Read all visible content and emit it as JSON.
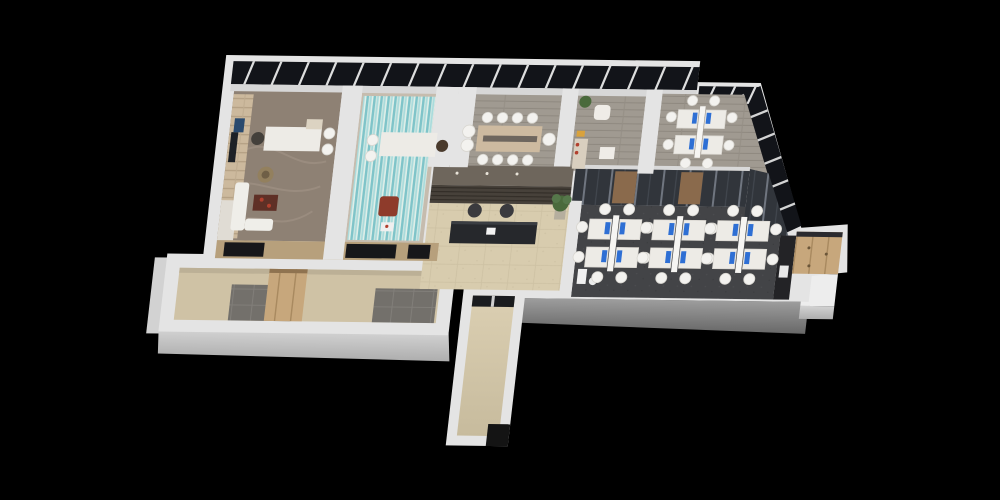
{
  "scene": {
    "type": "3d-isometric-office-floorplan-render",
    "rooms": [
      {
        "id": "executive-office",
        "floor": "wood-swirl-brown"
      },
      {
        "id": "meeting-room",
        "floor": "teal-striped-carpet"
      },
      {
        "id": "conference-room",
        "floor": "gray-wood-plank"
      },
      {
        "id": "lounge-pantry",
        "floor": "gray-wood-plank"
      },
      {
        "id": "private-office",
        "floor": "gray-wood-plank",
        "workstations": 4
      },
      {
        "id": "open-office",
        "floor": "dark-gray-carpet",
        "workstations": 12
      },
      {
        "id": "reception",
        "floor": "beige-marble"
      },
      {
        "id": "storage-locker-room",
        "floor": "light-wood-lockers"
      },
      {
        "id": "annex-utility-room",
        "floor": "gray-tile-and-wood"
      },
      {
        "id": "elevator-corridor",
        "floor": "beige-marble"
      }
    ],
    "facade": {
      "top_band": {
        "x": 234,
        "y": 61,
        "w": 466,
        "h": 23,
        "mullions": 17,
        "lean": 7
      },
      "right_band": {
        "x": 702,
        "y": 80,
        "w": 61,
        "h": 17,
        "mullions": 3,
        "lean": 6
      },
      "diagonal_band": {
        "x1": 763,
        "y1": 79,
        "x2": 820,
        "y2": 218,
        "dx": -16,
        "dy": 7,
        "mullions": 5
      }
    },
    "workstation_pods": {
      "pod": {
        "w": 52,
        "h": 56
      },
      "open_office": [
        [
          608,
          210
        ],
        [
          672,
          210
        ],
        [
          736,
          210
        ]
      ],
      "private_office": [
        [
          684,
          100
        ]
      ]
    },
    "furniture": {
      "executive_office": {
        "desk": {
          "x": 274,
          "y": 126,
          "w": 56,
          "h": 24
        },
        "exec_chair": [
          267,
          138
        ],
        "guest_chairs": [
          [
            338,
            132
          ],
          [
            338,
            148
          ]
        ],
        "sofa_a": {
          "x": 250,
          "y": 182,
          "w": 14,
          "h": 48
        },
        "sofa_b": {
          "x": 264,
          "y": 218,
          "w": 28,
          "h": 12
        },
        "coffee_table": {
          "x": 270,
          "y": 194,
          "w": 24,
          "h": 16
        },
        "rattan_chair": [
          279,
          174
        ],
        "tv": {
          "x": 240,
          "y": 132,
          "w": 7,
          "h": 30
        }
      },
      "meeting_room": {
        "desk": {
          "x": 390,
          "y": 130,
          "w": 56,
          "h": 24
        },
        "host_chair": [
          452,
          143
        ],
        "guest_chairs": [
          [
            382,
            138
          ],
          [
            382,
            154
          ]
        ],
        "armchair": {
          "x": 396,
          "y": 194,
          "w": 19,
          "h": 20
        },
        "magazine": {
          "x": 400,
          "y": 220,
          "w": 13,
          "h": 9
        }
      },
      "conference_room": {
        "table": {
          "x": 486,
          "y": 122,
          "w": 64,
          "h": 26
        },
        "chairs": [
          [
            494,
            114
          ],
          [
            509,
            114
          ],
          [
            524,
            114
          ],
          [
            539,
            114
          ],
          [
            494,
            156
          ],
          [
            509,
            156
          ],
          [
            524,
            156
          ],
          [
            539,
            156
          ],
          [
            477,
            128
          ],
          [
            477,
            142
          ],
          [
            558,
            135
          ]
        ]
      },
      "lounge": {
        "plant": [
          590,
          97
        ],
        "armchair": {
          "x": 600,
          "y": 100,
          "w": 16,
          "h": 15
        },
        "cabinet": {
          "x": 584,
          "y": 134,
          "w": 13,
          "h": 30
        },
        "side_table": {
          "x": 610,
          "y": 142,
          "w": 15,
          "h": 12
        }
      },
      "reception": {
        "counter": {
          "x": 470,
          "y": 218,
          "w": 86,
          "h": 22
        },
        "chairs": [
          [
            492,
            207
          ],
          [
            524,
            207
          ]
        ],
        "plant": [
          577,
          199
        ],
        "paper": {
          "x": 506,
          "y": 224,
          "w": 9,
          "h": 7
        }
      },
      "open_office_extras": {
        "dispenser": {
          "x": 602,
          "y": 264,
          "w": 9,
          "h": 15
        },
        "bin": [
          618,
          276
        ]
      },
      "copier_room": {
        "copier": {
          "x": 803,
          "y": 258,
          "w": 9,
          "h": 12
        }
      }
    }
  },
  "palette": {
    "bg": "#000000",
    "wall": "#e4e4e4",
    "wall-shade": "#cdcdcd",
    "face-gray-a": "#9d9d9d",
    "face-gray-b": "#6c6c6c",
    "window-dark": "#121419",
    "mullion": "#e9e9e9",
    "ceiling": "#d7d7d7",
    "exec-floor": "#8e8174",
    "carpet-dark": "#434447",
    "glass-dark": "#31353b",
    "wood-door": "#8a6a4c",
    "desk": "#edebe6",
    "chair-white": "#f3f2ef",
    "chair-dark": "#3a3a3e",
    "monitor-blue": "#2e6fd4",
    "counter-dark": "#26282c",
    "wood-band": "#b7a07c",
    "cabinet-wood": "#c7a77c",
    "tile-gray": "#73706b",
    "marble-beige": "#d8ccae",
    "accent-red": "#b2402e",
    "plant-green": "#4a6a3c"
  }
}
